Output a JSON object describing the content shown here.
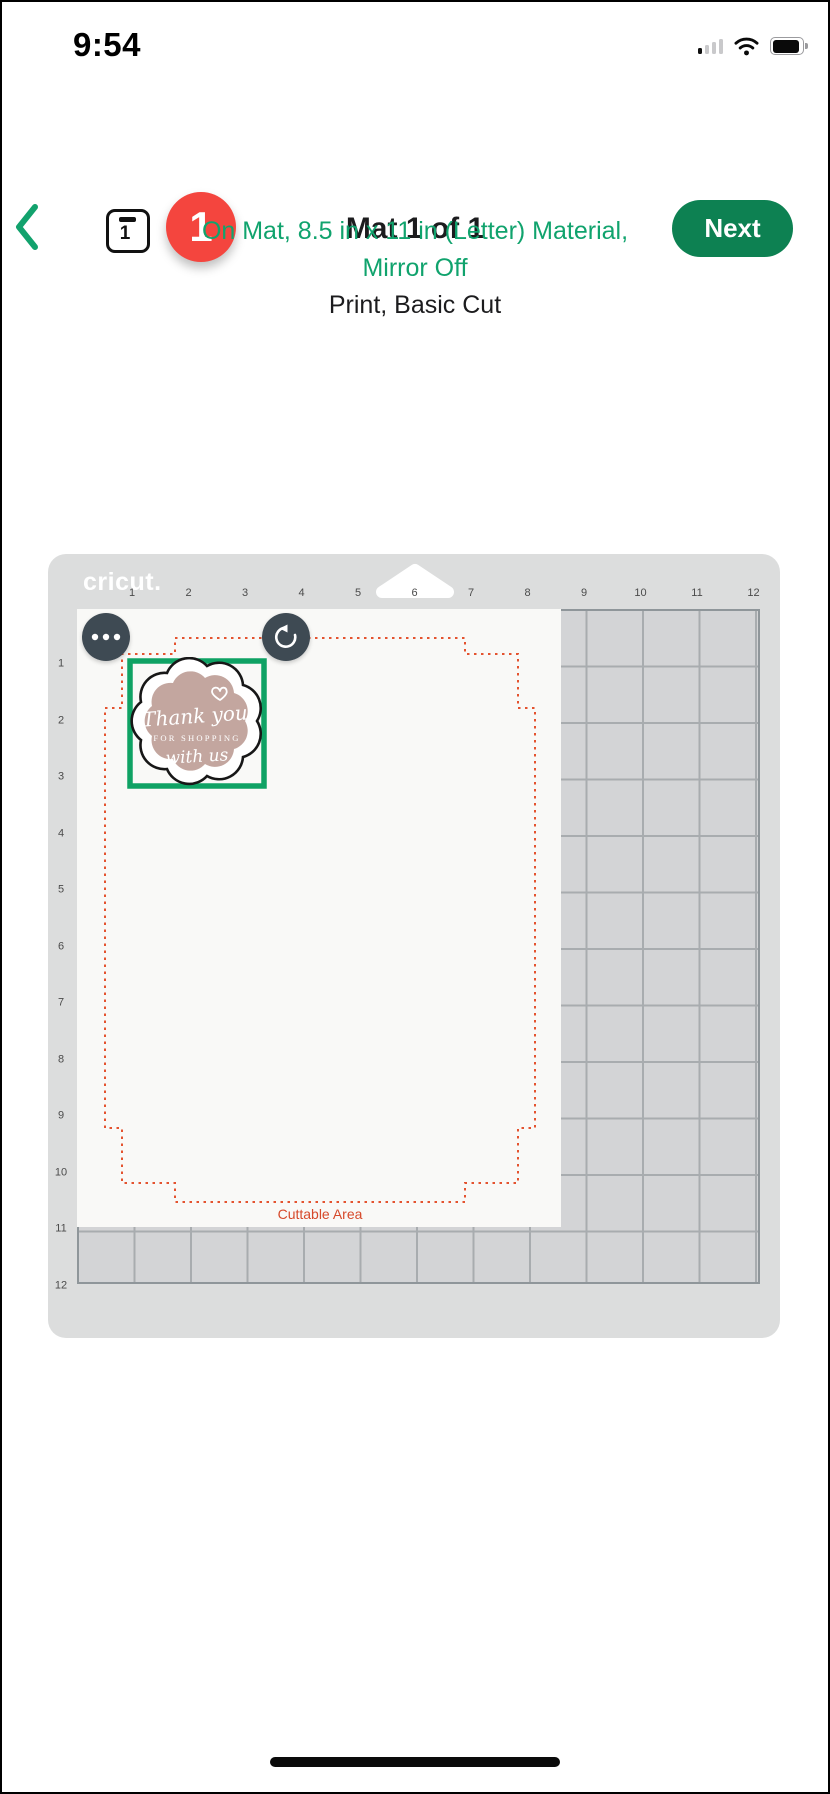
{
  "status_bar": {
    "time": "9:54",
    "signal_level": "1 of 4 bars",
    "wifi": "on",
    "battery": "full"
  },
  "header": {
    "back_label": "back",
    "mat_thumb_number": "1",
    "mat_badge_count": "1",
    "title": "Mat 1 of 1",
    "next_label": "Next"
  },
  "subtitle": {
    "line1": "On Mat, 8.5 in x 11 in (Letter) Material,",
    "line2": "Mirror Off",
    "line3": "Print, Basic Cut"
  },
  "mat": {
    "brand": "cricut.",
    "ruler_top": [
      "1",
      "2",
      "3",
      "4",
      "5",
      "6",
      "7",
      "8",
      "9",
      "10",
      "11",
      "12"
    ],
    "ruler_left": [
      "1",
      "2",
      "3",
      "4",
      "5",
      "6",
      "7",
      "8",
      "9",
      "10",
      "11",
      "12"
    ],
    "cuttable_area_label": "Cuttable Area",
    "material_size": "8.5 in x 11 in (Letter)"
  },
  "sticker": {
    "line1": "Thank you",
    "line2": "FOR SHOPPING",
    "line3": "with us"
  },
  "colors": {
    "accent_green_button": "#0d8152",
    "text_green": "#10a36d",
    "selection_green": "#0fa264",
    "badge_red": "#f4453e",
    "cut_line_red": "#e4532f",
    "cut_label_red": "#d6492a",
    "sticker_mauve": "#c3a69f",
    "circle_button_slate": "#3e4a53",
    "mat_gray": "#dcdddd"
  }
}
